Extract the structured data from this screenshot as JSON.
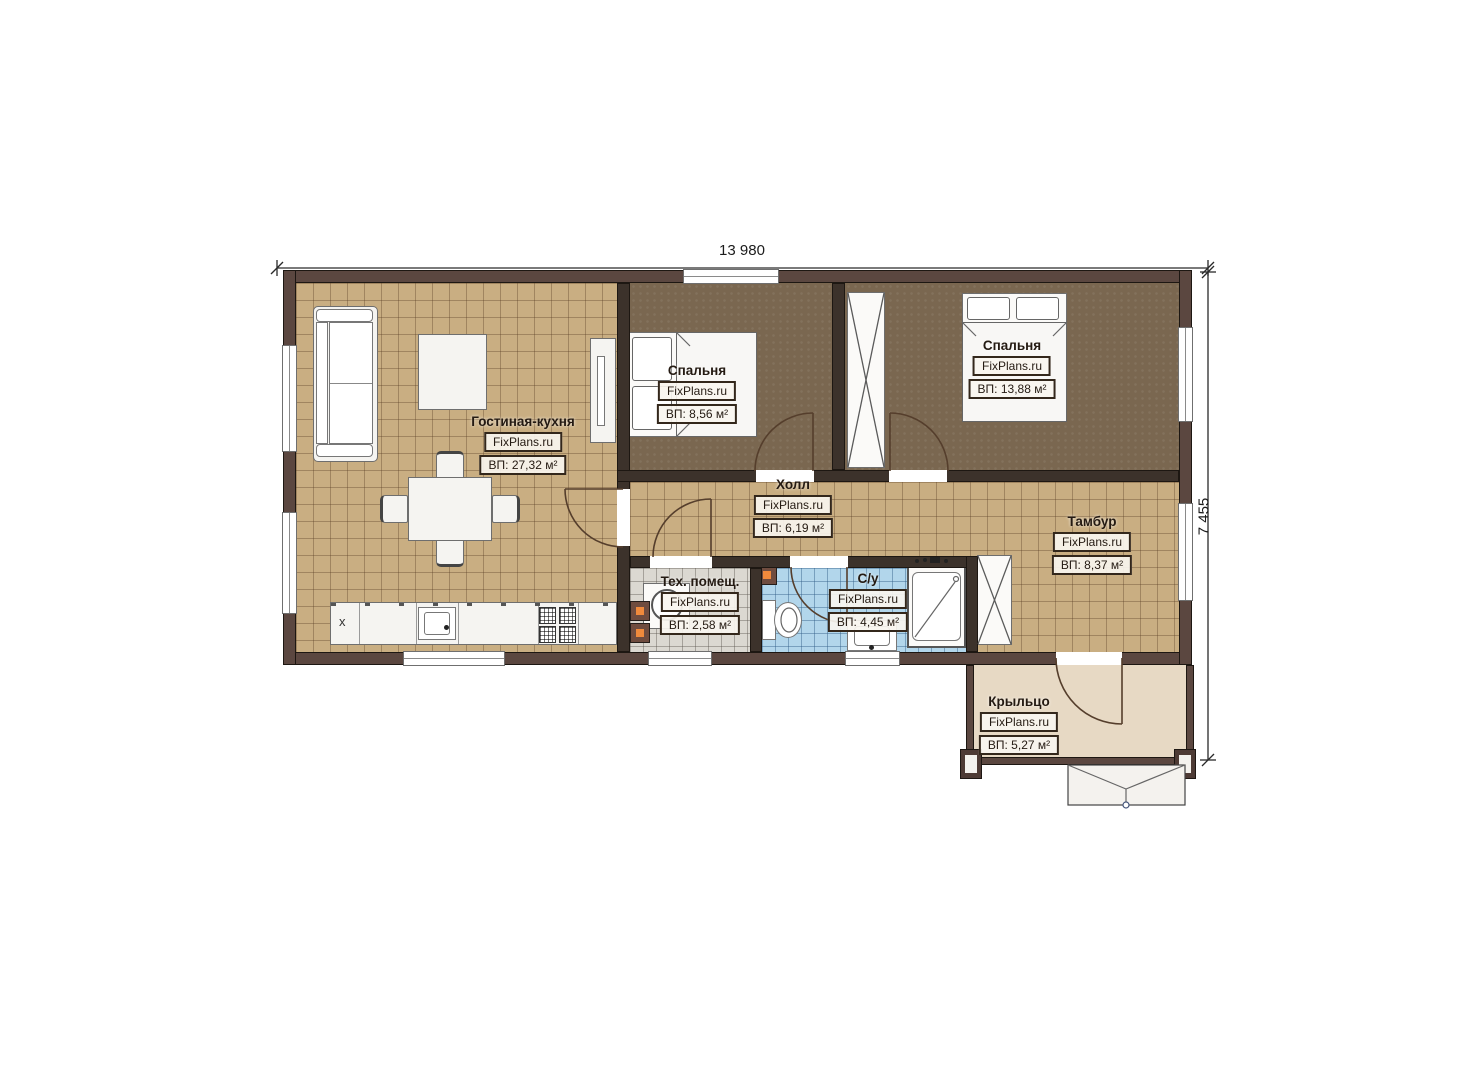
{
  "dimensions": {
    "width": "13 980",
    "height": "7 455"
  },
  "rooms": [
    {
      "key": "living",
      "name": "Гостиная-кухня",
      "site": "FixPlans.ru",
      "area": "ВП: 27,32 м²"
    },
    {
      "key": "bedroom1",
      "name": "Спальня",
      "site": "FixPlans.ru",
      "area": "ВП: 8,56 м²"
    },
    {
      "key": "bedroom2",
      "name": "Спальня",
      "site": "FixPlans.ru",
      "area": "ВП: 13,88 м²"
    },
    {
      "key": "hall",
      "name": "Холл",
      "site": "FixPlans.ru",
      "area": "ВП: 6,19 м²"
    },
    {
      "key": "vestibule",
      "name": "Тамбур",
      "site": "FixPlans.ru",
      "area": "ВП: 8,37 м²"
    },
    {
      "key": "tech",
      "name": "Тех. помещ.",
      "site": "FixPlans.ru",
      "area": "ВП: 2,58 м²"
    },
    {
      "key": "bath",
      "name": "С/у",
      "site": "FixPlans.ru",
      "area": "ВП: 4,45 м²"
    },
    {
      "key": "porch",
      "name": "Крыльцо",
      "site": "FixPlans.ru",
      "area": "ВП: 5,27 м²"
    }
  ],
  "furniture": {
    "fridge_mark": "x"
  },
  "colors": {
    "wall_ext": "#5b4740",
    "wall_int": "#3c322b",
    "floor_tan": "#c9ae82",
    "floor_bedroom": "#7a6750",
    "floor_tech": "#dbd8d1",
    "floor_bath": "#b2d6eb",
    "floor_porch": "#e7d9c4",
    "heater_accent": "#f08a3c"
  }
}
